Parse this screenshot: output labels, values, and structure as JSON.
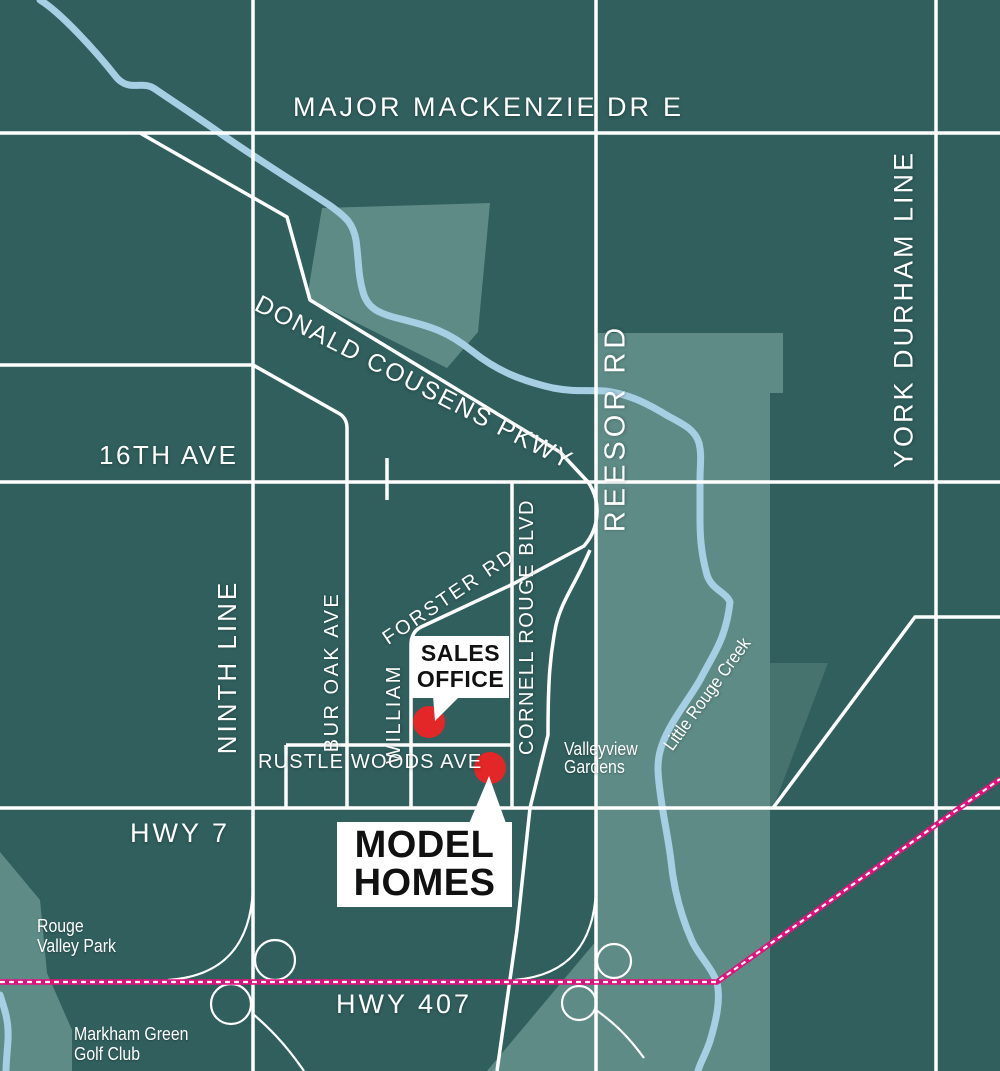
{
  "map": {
    "roads": {
      "major_mackenzie_1": "MAJOR MACKENZIE",
      "major_mackenzie_2": "DR",
      "major_mackenzie_3": "E",
      "sixteenth_ave": "16TH AVE",
      "donald_cousens_pkwy": "DONALD COUSENS PKWY",
      "ninth_line": "NINTH LINE",
      "bur_oak_ave": "BUR OAK AVE",
      "william_forster_1": "WILLIAM",
      "william_forster_2": "FORSTER RD",
      "cornell_rouge_blvd": "CORNELL ROUGE BLVD",
      "reesor_rd": "REESOR RD",
      "york_durham_line": "YORK DURHAM LINE",
      "rustle_woods_ave": "RUSTLE WOODS AVE",
      "hwy_7": "HWY 7",
      "hwy_407": "HWY 407"
    },
    "places": {
      "valleyview_gardens_1": "Valleyview",
      "valleyview_gardens_2": "Gardens",
      "rouge_valley_park_1": "Rouge",
      "rouge_valley_park_2": "Valley Park",
      "markham_green_1": "Markham Green",
      "markham_green_2": "Golf Club",
      "little_rouge_creek": "Little Rouge Creek"
    },
    "callouts": {
      "sales_office_1": "SALES",
      "sales_office_2": "OFFICE",
      "model_homes_1": "MODEL",
      "model_homes_2": "HOMES"
    },
    "colors": {
      "background": "#305f5d",
      "parkland_light": "#5e8b86",
      "parkland_medium": "#47736f",
      "road_white": "#ffffff",
      "creek_blue": "#a6cfe4",
      "hwy407_pink": "#e2107d",
      "marker_red": "#e32627",
      "callout_text": "#111111"
    }
  }
}
